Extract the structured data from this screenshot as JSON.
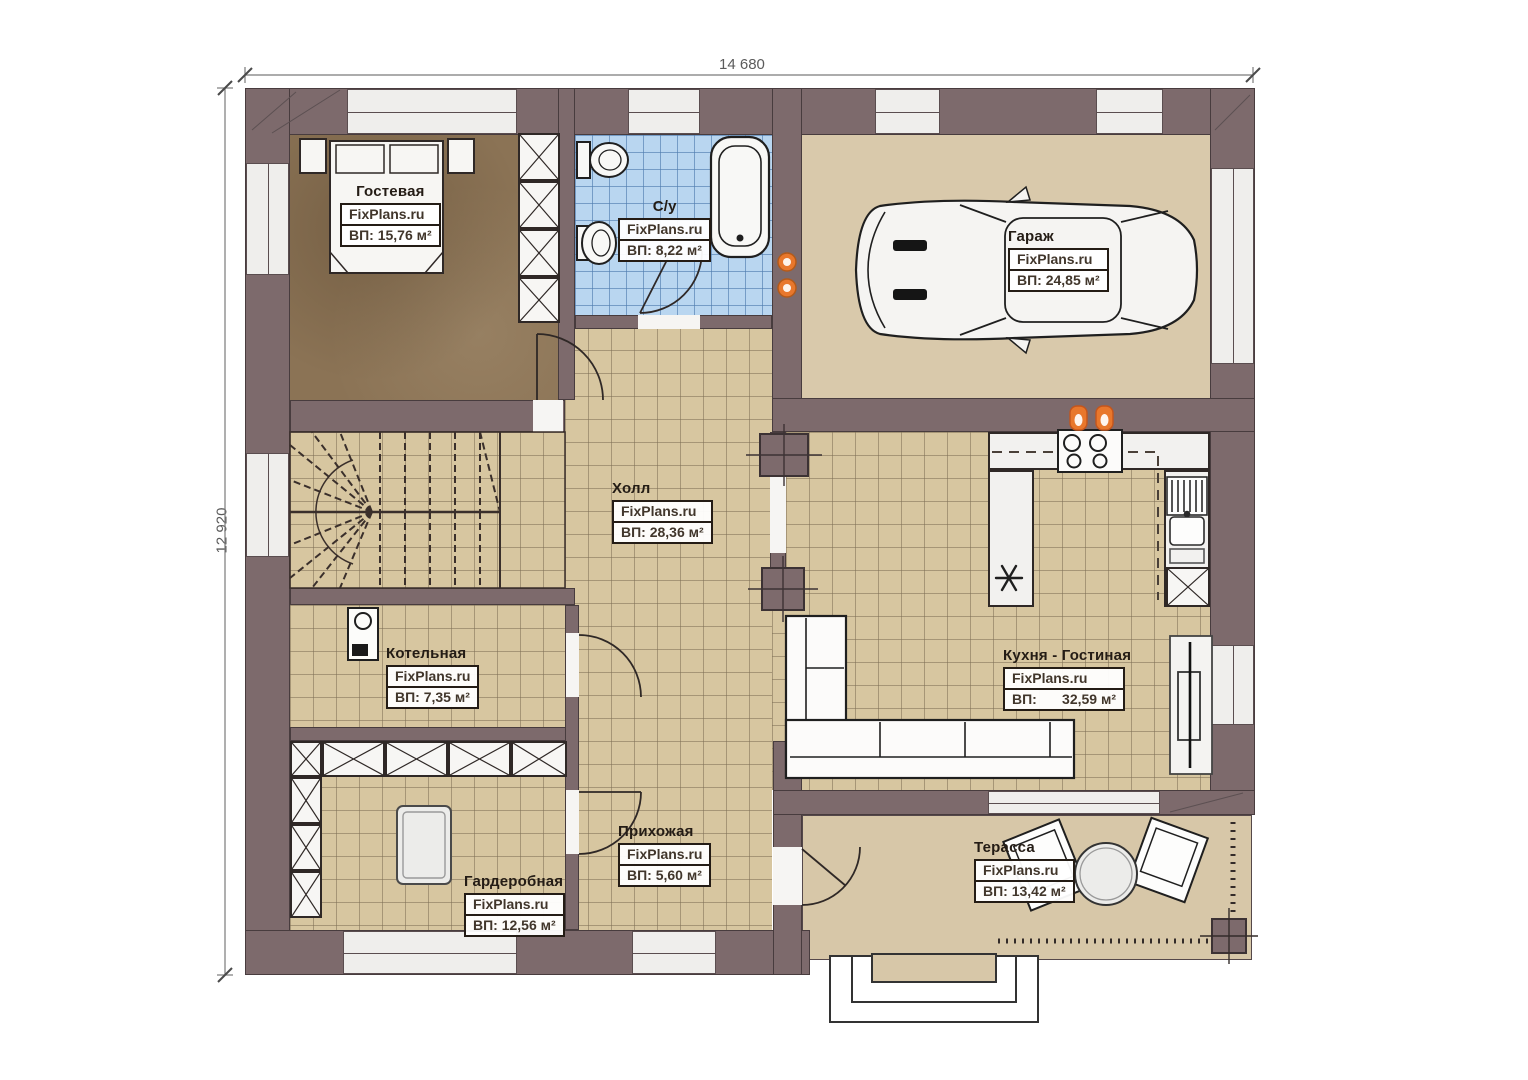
{
  "dimensions": {
    "width_label": "14 680",
    "height_label": "12 920"
  },
  "watermark": "FixPlans.ru",
  "rooms": {
    "guest": {
      "name": "Гостевая",
      "brand": "FixPlans.ru",
      "area": "ВП: 15,76 м²"
    },
    "bath": {
      "name": "С/у",
      "brand": "FixPlans.ru",
      "area": "ВП: 8,22 м²"
    },
    "garage": {
      "name": "Гараж",
      "brand": "FixPlans.ru",
      "area": "ВП: 24,85 м²"
    },
    "hall": {
      "name": "Холл",
      "brand": "FixPlans.ru",
      "area": "ВП: 28,36 м²"
    },
    "boiler": {
      "name": "Котельная",
      "brand": "FixPlans.ru",
      "area": "ВП: 7,35 м²"
    },
    "wardrobe": {
      "name": "Гардеробная",
      "brand": "FixPlans.ru",
      "area": "ВП: 12,56 м²"
    },
    "entry": {
      "name": "Прихожая",
      "brand": "FixPlans.ru",
      "area": "ВП: 5,60 м²"
    },
    "kitchen": {
      "name": "Кухня - Гостиная",
      "brand": "FixPlans.ru",
      "area_label": "ВП:",
      "area_value": "32,59 м²"
    },
    "terrace": {
      "name": "Терасса",
      "brand": "FixPlans.ru",
      "area": "ВП: 13,42 м²"
    }
  },
  "colors": {
    "wall": "#7d6a6c",
    "floor_tile": "#d7c6a0",
    "floor_grid": "#8d7d65",
    "guest_floor": "#8b7355",
    "garage_floor": "#d9c9ab",
    "terrace_floor": "#d7c7a8",
    "bathroom_tile": "#b9d6f0",
    "bathroom_grid": "#6f9cc9",
    "window_fill": "#efeeec",
    "label_border": "#241c15",
    "accent_orange": "#e8772c"
  }
}
